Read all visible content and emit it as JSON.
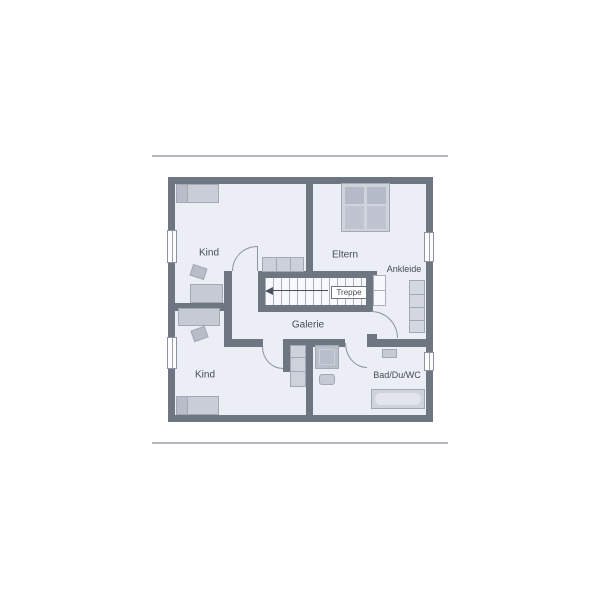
{
  "figure": {
    "type": "floor-plan-upper-storey",
    "labels": {
      "kind_top": "Kind",
      "eltern": "Eltern",
      "ankleide": "Ankleide",
      "treppe": "Treppe",
      "galerie": "Galerie",
      "kind_bottom": "Kind",
      "bad": "Bad/Du/WC"
    },
    "colors": {
      "wall": "#6e7682",
      "room_fill": "#ebeef4",
      "stairs_fill": "#f7f8fb",
      "furniture": "#c9cdd7",
      "label_text": "#454c5a",
      "page_rule": "#b4b7be"
    }
  }
}
